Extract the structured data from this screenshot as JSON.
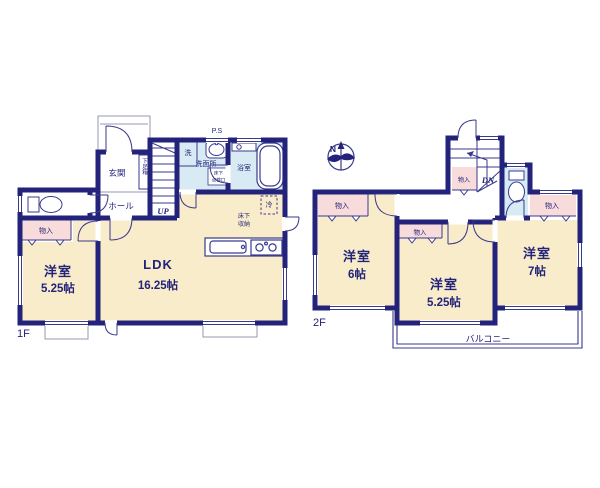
{
  "colors": {
    "wall": "#23237b",
    "thin_line": "#3a3a8c",
    "gray_line": "#9a9ab0",
    "room_fill": "#f8ecca",
    "closet_fill": "#f8dbdb",
    "wet_fill": "#d8ebf4",
    "text": "#23237b"
  },
  "floor1": {
    "floor_label": "1F",
    "room_ldk_name": "LDK",
    "room_ldk_size": "16.25帖",
    "room_west_name": "洋室",
    "room_west_size": "5.25帖",
    "entrance": "玄関",
    "hall": "ホール",
    "shoe_cabinet": "下足箱",
    "stairs_up": "UP",
    "laundry": "洗",
    "washroom": "洗面所",
    "underfloor_hatch": [
      "床下",
      "点検口"
    ],
    "bathroom": "浴室",
    "pipe_space": "P.S",
    "fridge": "冷",
    "underfloor_storage": [
      "床下",
      "収納"
    ],
    "closet": "物入"
  },
  "floor2": {
    "floor_label": "2F",
    "compass_north": "N",
    "stairs_down": "DN",
    "closet_stair": "物入",
    "closet_left": "物入",
    "closet_middle": "物入",
    "closet_right": "物入",
    "room_left_name": "洋室",
    "room_left_size": "6帖",
    "room_middle_name": "洋室",
    "room_middle_size": "5.25帖",
    "room_right_name": "洋室",
    "room_right_size": "7帖",
    "balcony": "バルコニー"
  }
}
